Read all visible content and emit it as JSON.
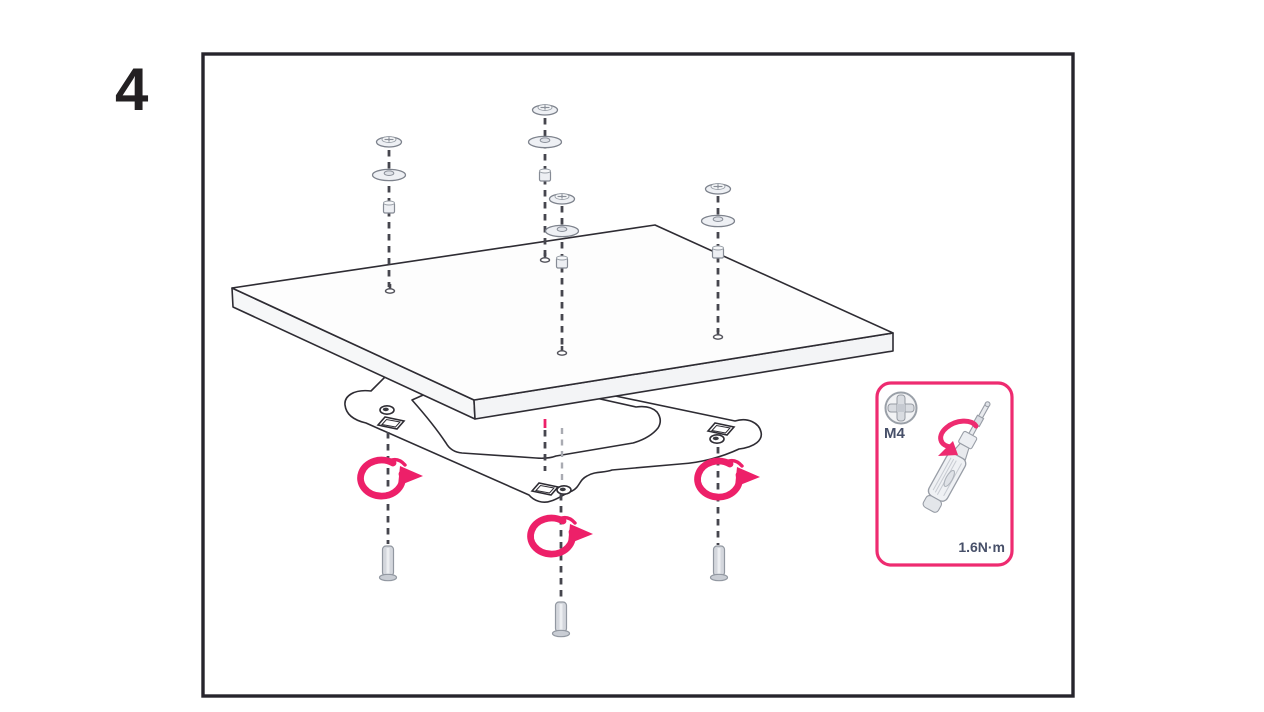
{
  "step": {
    "number": "4"
  },
  "frame": {
    "border_color": "#26242c"
  },
  "figure": {
    "accent_color": "#ed2069",
    "line_color": "#2e2c33",
    "panel": "flat-panel",
    "bracket": "mounting-bracket",
    "top_screw_assemblies": 4,
    "bottom_screws": 3,
    "rotation_arrows": 3
  },
  "inset": {
    "border_color": "#ee2b70",
    "screw_icon": "phillips-screw-head-icon",
    "screw_size_label": "M4",
    "tool_icon": "torque-screwdriver-icon",
    "rotation_icon": "rotation-arrow-icon",
    "torque_label": "1.6N·m",
    "label_color": "#475069"
  }
}
